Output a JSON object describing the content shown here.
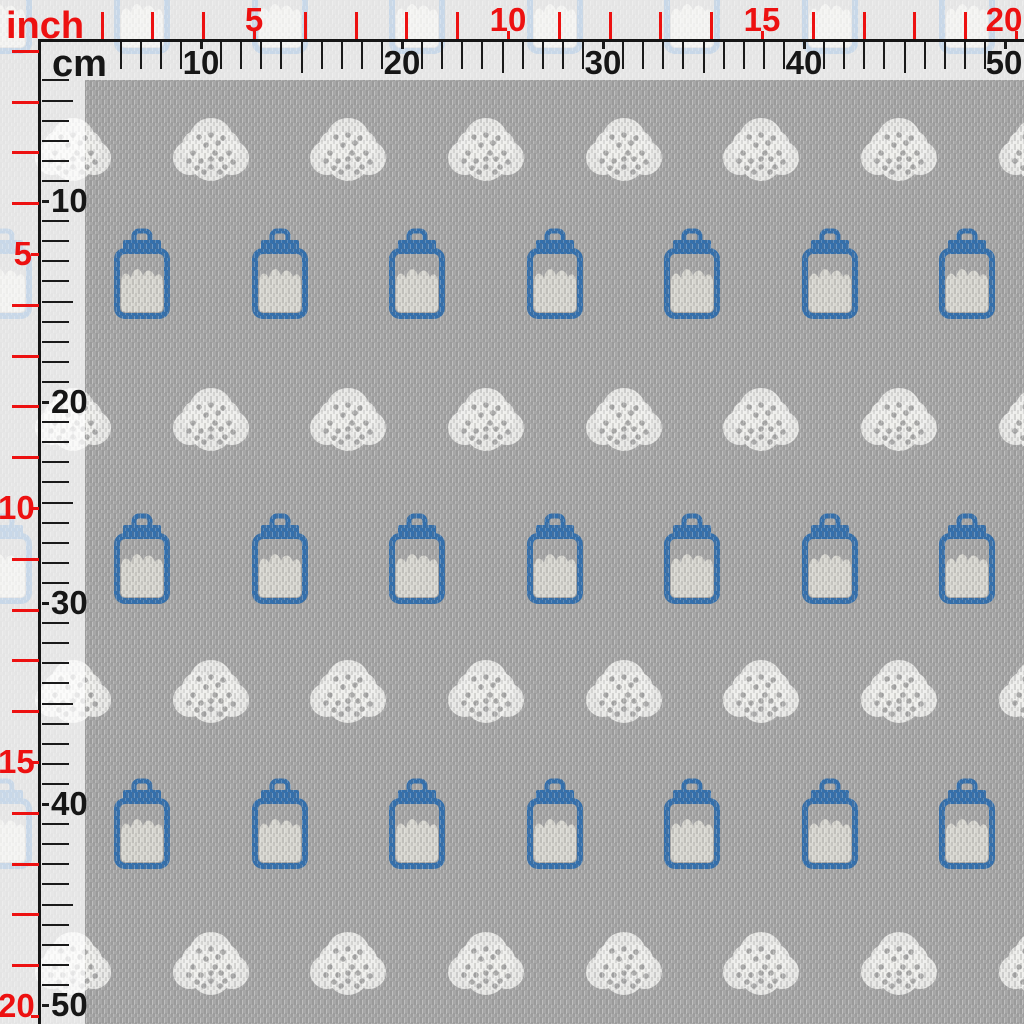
{
  "preview": {
    "description": "gray woven fabric swatch with repeating pattern of white dotted clouds and blue milk jars, shown under inch and cm measuring rulers"
  },
  "rulers": {
    "inch_label": "inch",
    "cm_label": "cm",
    "px_per_inch": 50.8,
    "px_per_cm": 20.1,
    "inch_numbers": [
      5,
      10,
      15,
      20
    ],
    "cm_numbers": [
      10,
      20,
      30,
      40,
      50
    ],
    "top_inch_tick_start": 2,
    "top_inch_tick_end": 20,
    "top_cm_tick_start": 6,
    "top_cm_tick_end": 50,
    "left_inch_tick_start": 1,
    "left_inch_tick_end": 20,
    "left_cm_tick_start": 4,
    "left_cm_tick_end": 50,
    "inch_color": "#ed1111",
    "cm_color": "#161616"
  },
  "colors": {
    "fabric_base": "#a7a7a7",
    "jar_blue": "#3470ad",
    "milk_fill": "#d9d8d2",
    "cloud_white": "#eeeeec",
    "cloud_dot": "#a3a3a3",
    "overlay_white": "rgba(255,255,255,0.73)"
  },
  "pattern": {
    "jar_columns_x": [
      4,
      142,
      280,
      417,
      555,
      692,
      830,
      967
    ],
    "cloud_columns_x": [
      73,
      211,
      348,
      486,
      624,
      761,
      899,
      1037
    ],
    "rows": [
      {
        "type": "jar",
        "y": 8
      },
      {
        "type": "cloud",
        "y": 150
      },
      {
        "type": "jar",
        "y": 273
      },
      {
        "type": "cloud",
        "y": 420
      },
      {
        "type": "jar",
        "y": 558
      },
      {
        "type": "cloud",
        "y": 692
      },
      {
        "type": "jar",
        "y": 823
      },
      {
        "type": "cloud",
        "y": 964
      }
    ],
    "jar_size": {
      "w": 56,
      "h": 92
    },
    "cloud_size": {
      "w": 80,
      "h": 70
    },
    "cloud_dots": [
      [
        22,
        38
      ],
      [
        30,
        46
      ],
      [
        40,
        52
      ],
      [
        50,
        44
      ],
      [
        58,
        38
      ],
      [
        35,
        30
      ],
      [
        47,
        28
      ],
      [
        26,
        53
      ],
      [
        54,
        52
      ],
      [
        44,
        38
      ],
      [
        18,
        46
      ],
      [
        62,
        47
      ],
      [
        33,
        57
      ],
      [
        49,
        57
      ],
      [
        40,
        20
      ],
      [
        28,
        22
      ],
      [
        52,
        23
      ],
      [
        40,
        44
      ]
    ]
  }
}
